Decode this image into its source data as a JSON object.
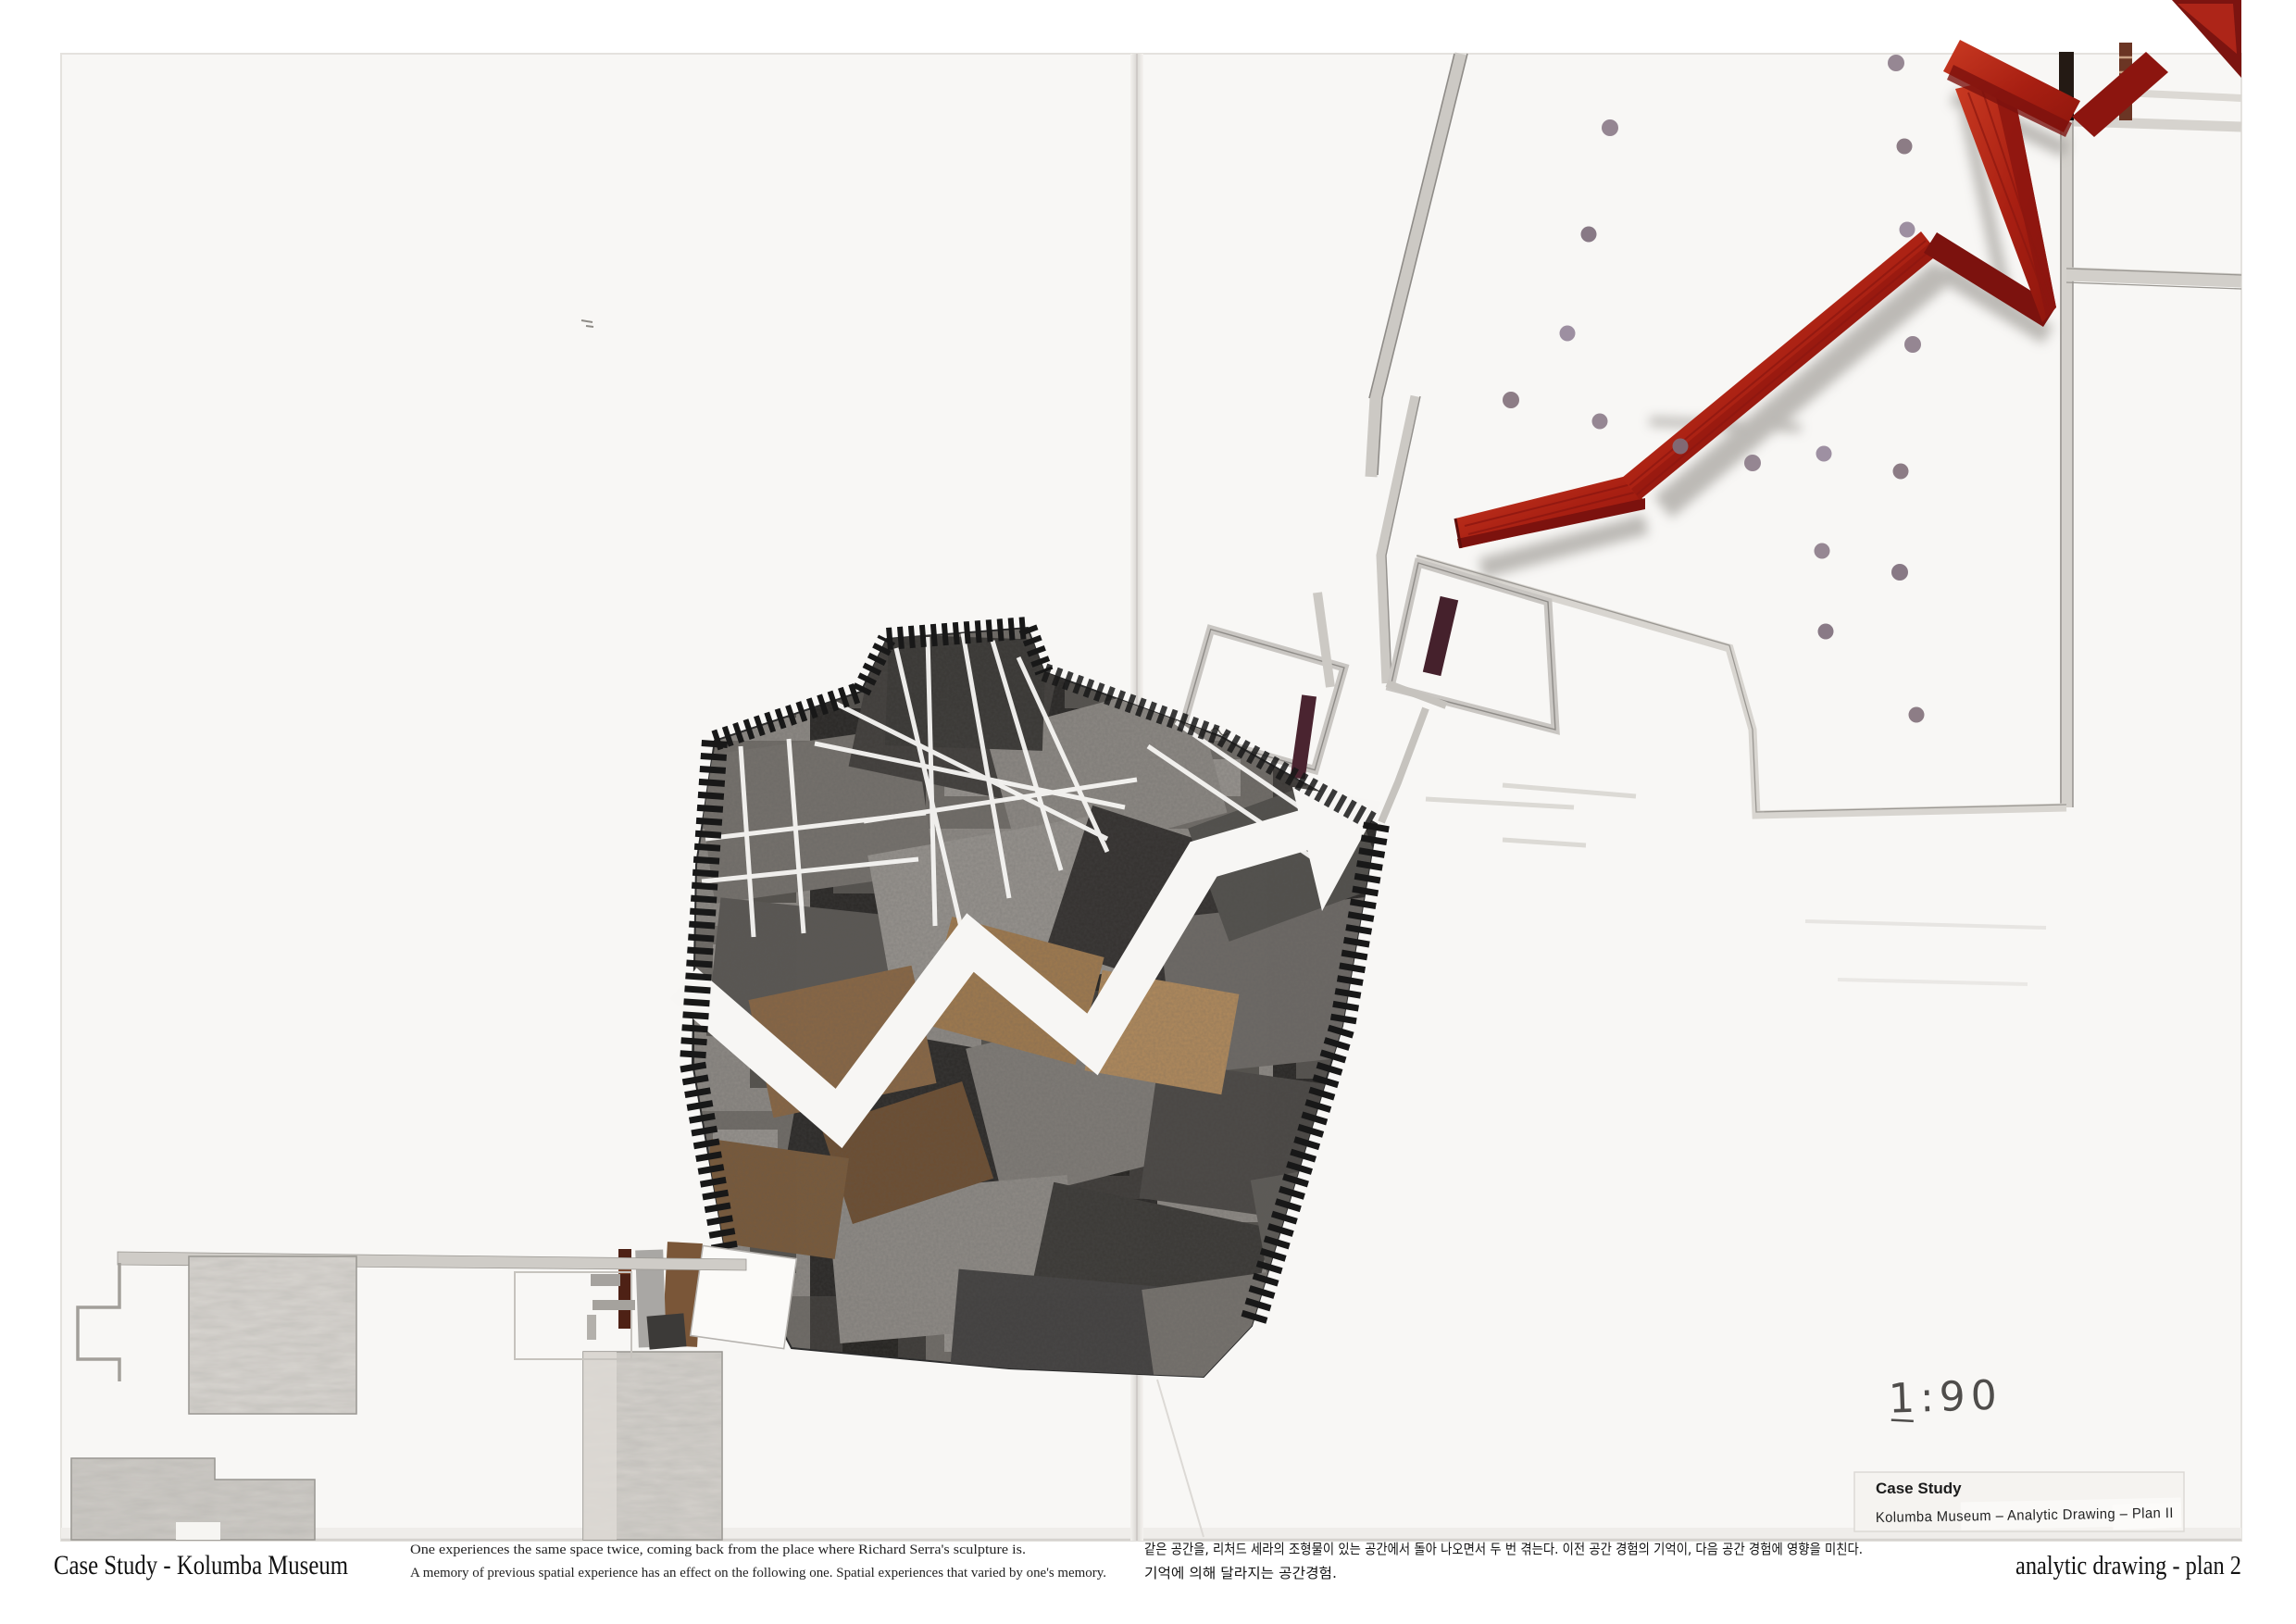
{
  "board": {
    "kind": "architectural analytic drawing presentation board",
    "scale_note": "1:90",
    "colors": {
      "scan_background": "#ffffff",
      "paper": "#f8f7f5",
      "accent_red_bright": "#b42a1a",
      "accent_red_dark": "#7c120e",
      "pencil_gray": "#cdcac5",
      "door_maroon": "#45212c",
      "collage_sepia": "#8a6744",
      "stripe_black": "#181818",
      "column_dot": "#8d7d8a"
    }
  },
  "captions": {
    "title_left": "Case Study - Kolumba Museum",
    "statement_en": [
      "One experiences the same space twice, coming back from the place where Richard Serra's sculpture is.",
      "A memory of previous spatial experience has an effect on the following one. Spatial experiences that varied by one's memory."
    ],
    "statement_kr": [
      "같은 공간을, 리처드 세라의 조형물이 있는 공간에서 돌아 나오면서 두 번 겪는다. 이전 공간 경험의 기억이, 다음 공간 경험에 영향을 미친다.",
      "기억에 의해 달라지는 공간경험."
    ],
    "title_right": "analytic drawing - plan 2"
  },
  "label_box": {
    "line1": "Case Study",
    "line2": "Kolumba Museum – Analytic Drawing – Plan II"
  },
  "annotations": {
    "scale_note": "1:90"
  }
}
